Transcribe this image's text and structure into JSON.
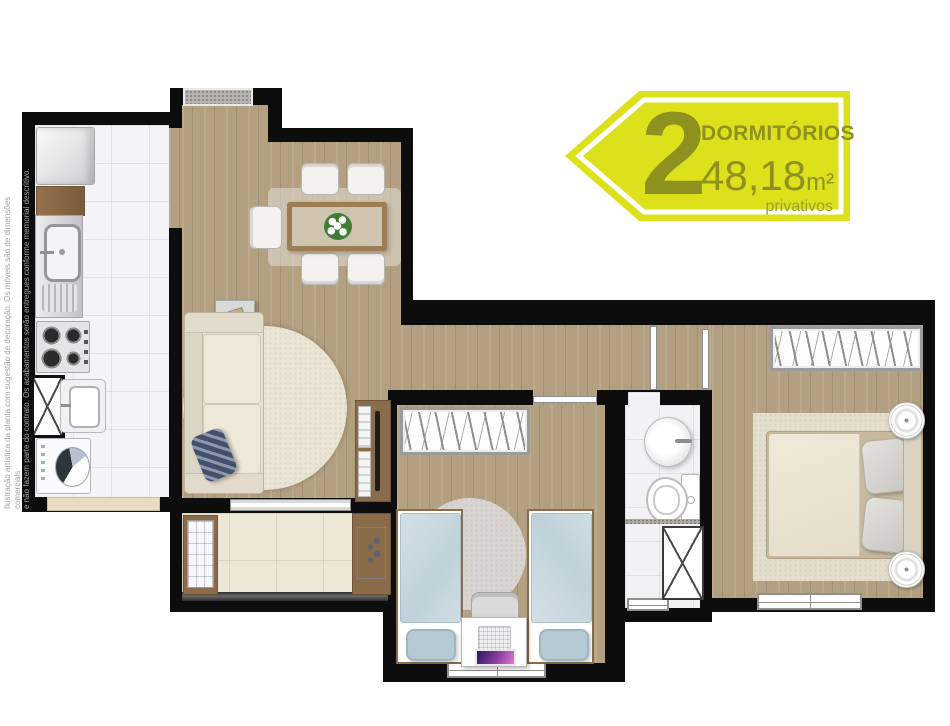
{
  "badge": {
    "number": "2",
    "label": "DORMITÓRIOS",
    "area": "48,18",
    "area_unit": "m²",
    "sublabel": "privativos",
    "fill_color": "#dde11c",
    "text_color": "#8d921f"
  },
  "disclaimer": {
    "line1": "Ilustração artística da planta com sugestão de decoração. Os móveis são de dimensões comerciais",
    "line2": "e não fazem parte do contrato. Os acabamentos serão entregues conforme memorial descritivo."
  },
  "colors": {
    "wall": "#0d0d0d",
    "wood_floor": "#b3a080",
    "kitchen_tile": "#f4f4f6",
    "bathroom_tile": "#f2f2f4",
    "balcony_tile": "#ece7d5",
    "badge_yellow": "#dde11c",
    "badge_olive": "#8d921f",
    "disclaimer_gray": "#a3a3a3"
  }
}
